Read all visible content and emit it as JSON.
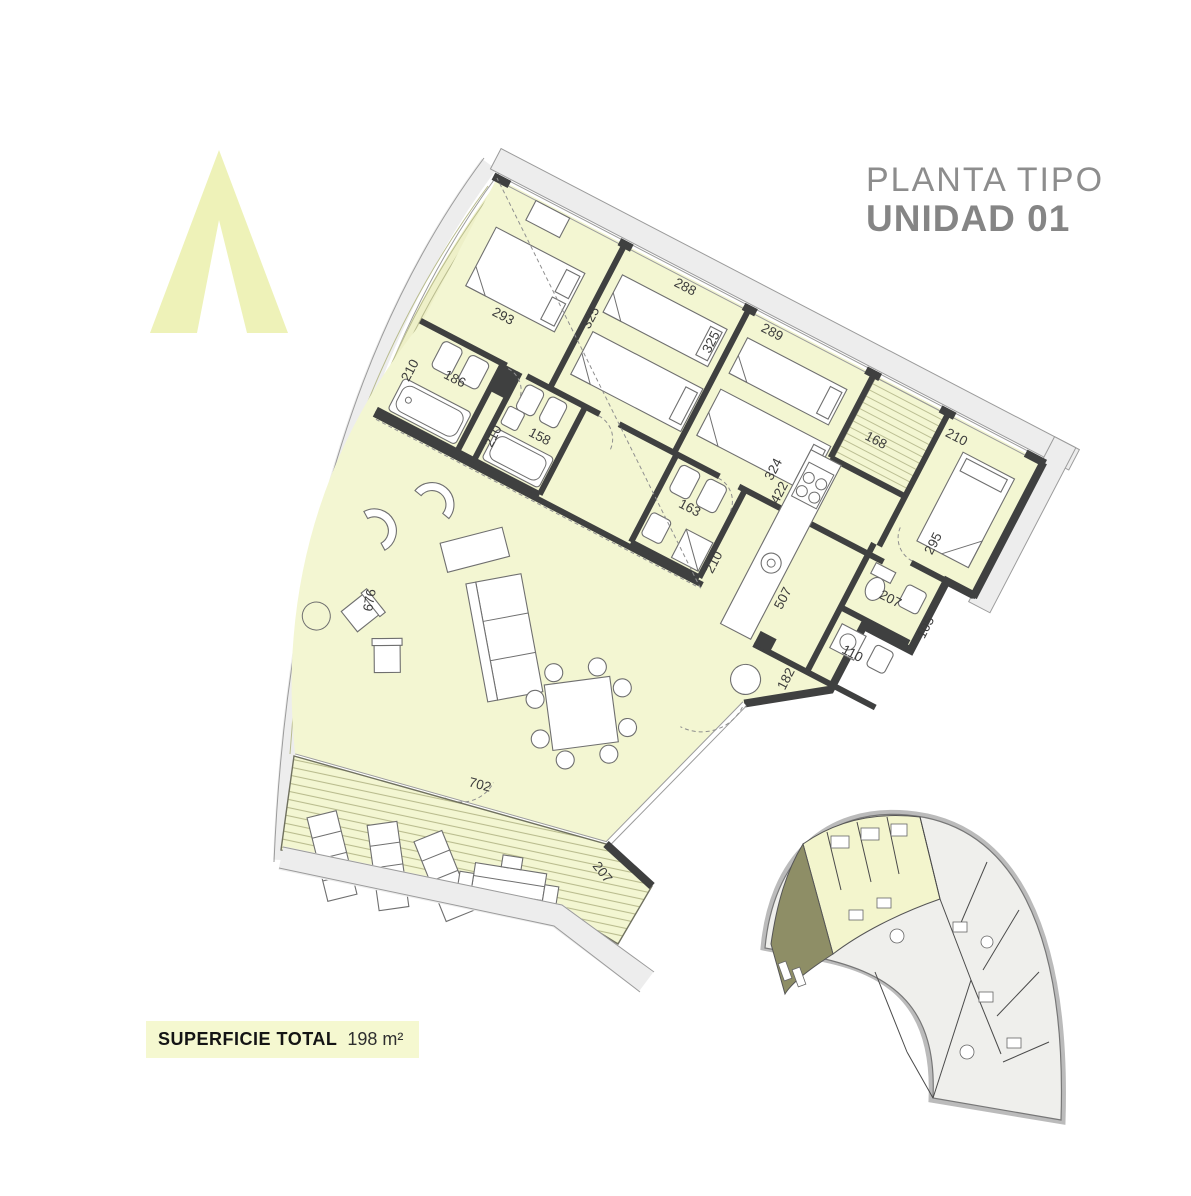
{
  "header": {
    "line1": "PLANTA TIPO",
    "line2": "UNIDAD 01"
  },
  "footer": {
    "label": "SUPERFICIE TOTAL",
    "value": "198 m²"
  },
  "colors": {
    "room_fill": "#f3f6d2",
    "wall": "#3f4040",
    "facade_band": "#ececec",
    "deck_line": "#b9bc8e",
    "minimap_highlight": "#f3f5cd",
    "minimap_terrace": "#8e8e66",
    "logo": "#eef2b8",
    "title_text": "#8d8d8d",
    "dim_text": "#3c3c3c"
  },
  "plan": {
    "dims_grid": [
      {
        "t": "293",
        "x": 58,
        "y": 124,
        "r": 0
      },
      {
        "t": "325",
        "x": 152,
        "y": 92,
        "r": -90
      },
      {
        "t": "288",
        "x": 206,
        "y": 14,
        "r": 0
      },
      {
        "t": "325",
        "x": 270,
        "y": 58,
        "r": -90
      },
      {
        "t": "289",
        "x": 304,
        "y": 14,
        "r": 0
      },
      {
        "t": "324",
        "x": 384,
        "y": 142,
        "r": -90
      },
      {
        "t": "422",
        "x": 400,
        "y": 160,
        "r": -90
      },
      {
        "t": "168",
        "x": 446,
        "y": 62,
        "r": 0
      },
      {
        "t": "210",
        "x": 516,
        "y": 22,
        "r": 0
      },
      {
        "t": "295",
        "x": 560,
        "y": 134,
        "r": -90
      },
      {
        "t": "210",
        "x": 16,
        "y": 222,
        "r": -90
      },
      {
        "t": "186",
        "x": 44,
        "y": 202,
        "r": 0
      },
      {
        "t": "210",
        "x": 120,
        "y": 242,
        "r": -90
      },
      {
        "t": "158",
        "x": 146,
        "y": 214,
        "r": 0
      },
      {
        "t": "163",
        "x": 312,
        "y": 208,
        "r": 0
      },
      {
        "t": "210",
        "x": 374,
        "y": 252,
        "r": -90
      },
      {
        "t": "507",
        "x": 452,
        "y": 252,
        "r": -90
      },
      {
        "t": "207",
        "x": 532,
        "y": 196,
        "r": 0
      },
      {
        "t": "105",
        "x": 592,
        "y": 212,
        "r": -90
      },
      {
        "t": "110",
        "x": 524,
        "y": 262,
        "r": 0
      },
      {
        "t": "182",
        "x": 492,
        "y": 322,
        "r": -90
      }
    ],
    "dims_screen": [
      {
        "t": "676",
        "x": 372,
        "y": 612,
        "r": -80
      },
      {
        "t": "702",
        "x": 468,
        "y": 786,
        "r": 15
      },
      {
        "t": "207",
        "x": 592,
        "y": 866,
        "r": 52
      }
    ]
  },
  "minimap": {
    "highlight_unit": "01"
  }
}
